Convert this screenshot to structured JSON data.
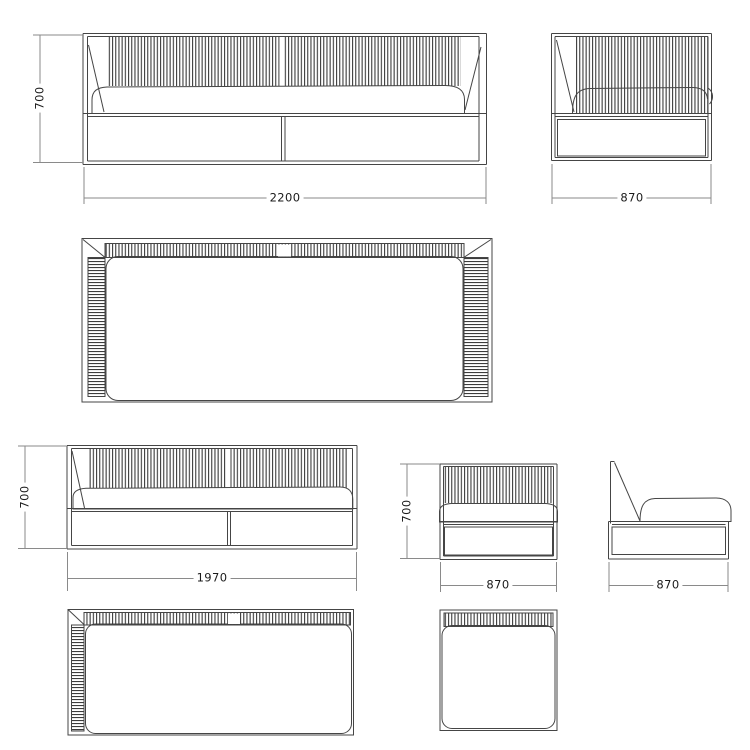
{
  "meta": {
    "title": "furniture-technical-drawing",
    "background_color": "#ffffff",
    "object_line_color": "#454545",
    "dimension_line_color": "#8a8a8a",
    "text_color": "#1b1b1b"
  },
  "views": [
    {
      "name": "sofa-front-view",
      "description": "3-seat sofa front elevation"
    },
    {
      "name": "sofa-side-view",
      "description": "sofa side elevation"
    },
    {
      "name": "sofa-top-view",
      "description": "sofa plan view"
    },
    {
      "name": "loveseat-front-view",
      "description": "open-end sofa front elevation"
    },
    {
      "name": "armchair-front-view",
      "description": "armless chair front elevation"
    },
    {
      "name": "armchair-side-view",
      "description": "armless chair side elevation"
    },
    {
      "name": "loveseat-top-view",
      "description": "open-end sofa plan view"
    },
    {
      "name": "armchair-top-view",
      "description": "armless chair plan view"
    }
  ],
  "dims": {
    "sofa_front": {
      "height": "700",
      "width": "2200"
    },
    "sofa_side": {
      "width": "870"
    },
    "loveseat_front": {
      "height": "700",
      "width": "1970"
    },
    "armchair_front": {
      "height": "700",
      "width": "870"
    },
    "armchair_side": {
      "width": "870"
    }
  }
}
